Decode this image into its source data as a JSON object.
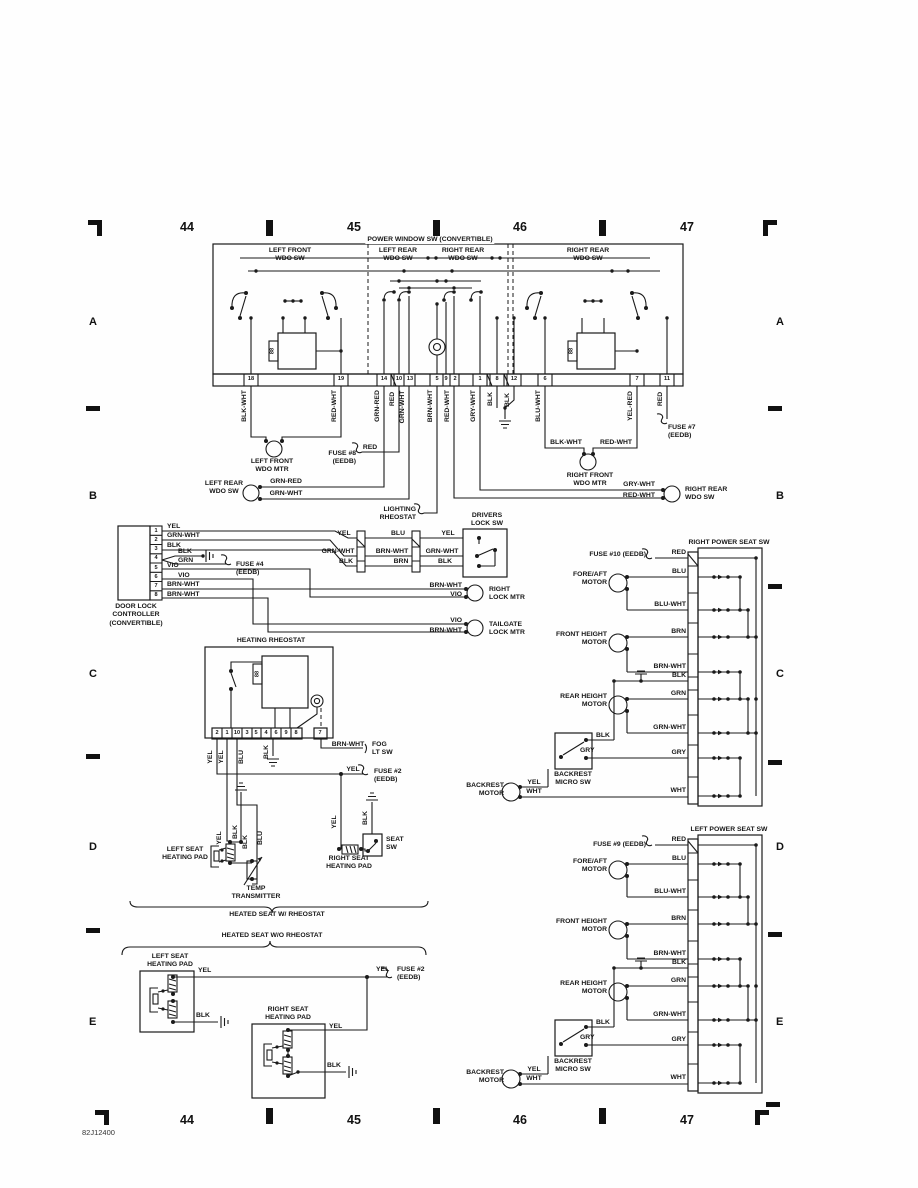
{
  "colors": {
    "ink": "#1a1a1a",
    "paper": "#fefefe"
  },
  "ruler": {
    "top_numbers": [
      "44",
      "45",
      "46",
      "47"
    ],
    "bottom_numbers": [
      "44",
      "45",
      "46",
      "47"
    ],
    "row_letters": [
      "A",
      "B",
      "C",
      "D",
      "E"
    ],
    "code": "82J12400"
  },
  "window_sw": {
    "title": "POWER WINDOW SW (CONVERTIBLE)",
    "sec1": "LEFT FRONT\nWDO SW",
    "sec2": "LEFT REAR\nWDO SW",
    "sec3": "RIGHT REAR\nWDO SW",
    "sec4": "RIGHT REAR\nWDO SW",
    "relay": "88",
    "pins": [
      "18",
      "19",
      "14",
      "10",
      "13",
      "5",
      "9",
      "2",
      "1",
      "8",
      "12",
      "6",
      "7",
      "11"
    ],
    "wire_labels": [
      "BLK-WHT",
      "RED-WHT",
      "GRN-RED",
      "RED",
      "GRN-WHT",
      "BRN-WHT",
      "RED-WHT",
      "GRY-WHT",
      "BLK",
      "BLK",
      "BLU-WHT",
      "YEL-RED",
      "RED"
    ],
    "left_front_mtr": "LEFT FRONT\nWDO MTR",
    "fuse8": "FUSE #8\n(EEDB)",
    "fuse8_wire": "RED",
    "left_rear_sw": "LEFT REAR\nWDO SW",
    "left_rear_wires": [
      "GRN-RED",
      "GRN-WHT"
    ],
    "lighting_rheostat": "LIGHTING\nRHEOSTAT",
    "right_front_mtr": "RIGHT FRONT\nWDO MTR",
    "right_front_wires": [
      "BLK-WHT",
      "RED-WHT"
    ],
    "fuse7": "FUSE #7\n(EEDB)",
    "right_rear_sw": "RIGHT REAR\nWDO SW",
    "right_rear_wires": [
      "GRY-WHT",
      "RED-WHT"
    ]
  },
  "door_lock": {
    "controller": "DOOR LOCK\nCONTROLLER\n(CONVERTIBLE)",
    "pins": [
      "1",
      "2",
      "3",
      "4",
      "5",
      "6",
      "7",
      "8"
    ],
    "pin_wires": [
      "YEL",
      "GRN-WHT",
      "BLK",
      "BLK",
      "GRN",
      "VIO",
      "VIO",
      "BRN-WHT",
      "BRN-WHT"
    ],
    "fuse4": "FUSE #4\n(EEDB)",
    "mid_top": [
      "YEL",
      "BLU",
      "YEL"
    ],
    "mid_mid": [
      "GRN-WHT",
      "BRN-WHT",
      "GRN-WHT"
    ],
    "mid_bot": [
      "BLK",
      "BRN",
      "BLK"
    ],
    "drivers_lock_sw": "DRIVERS\nLOCK SW",
    "right_lock_wires": [
      "BRN-WHT",
      "VIO"
    ],
    "right_lock_mtr": "RIGHT\nLOCK MTR",
    "tailgate_wires": [
      "VIO",
      "BRN-WHT"
    ],
    "tailgate_lock_mtr": "TAILGATE\nLOCK MTR"
  },
  "heating": {
    "title": "HEATING RHEOSTAT",
    "relay": "88",
    "pins": [
      "2",
      "1",
      "10",
      "3",
      "5",
      "4",
      "6",
      "9",
      "8",
      "7"
    ],
    "pin_wires": [
      "YEL",
      "YEL",
      "BLU",
      "BLK"
    ],
    "fog_wire": "BRN-WHT",
    "fog_label": "FOG\nLT SW",
    "fuse2_wire": "YEL",
    "fuse2_label": "FUSE #2\n(EEDB)",
    "left_pad_label": "LEFT SEAT\nHEATING PAD",
    "left_pad_wires": [
      "YEL",
      "BLK",
      "BLK",
      "BLU"
    ],
    "temp_transmitter": "TEMP\nTRANSMITTER",
    "right_pad_label": "RIGHT SEAT\nHEATING PAD",
    "right_pad_wire": "YEL",
    "seat_sw_label": "SEAT\nSW",
    "seat_sw_wire": "BLK",
    "brace1": "HEATED SEAT W/ RHEOSTAT",
    "brace2": "HEATED SEAT W/O RHEOSTAT"
  },
  "no_rheostat": {
    "left_pad": "LEFT SEAT\nHEATING PAD",
    "left_wires": [
      "YEL",
      "BLK"
    ],
    "fuse2_wire": "YEL",
    "fuse2_label": "FUSE #2\n(EEDB)",
    "right_pad": "RIGHT SEAT\nHEATING PAD",
    "right_wires": [
      "YEL",
      "BLK"
    ]
  },
  "seat_right": {
    "title": "RIGHT POWER SEAT SW",
    "fuse": "FUSE #10 (EEDB)",
    "rows": [
      "RED",
      "BLU",
      "BLU-WHT",
      "BRN",
      "BRN-WHT",
      "BLK",
      "GRN",
      "GRN-WHT",
      "GRY",
      "WHT"
    ],
    "fore_aft": "FORE/AFT\nMOTOR",
    "front_height": "FRONT HEIGHT\nMOTOR",
    "rear_height": "REAR HEIGHT\nMOTOR",
    "micro_sw": "BACKREST\nMICRO SW",
    "micro_wires": [
      "BLK",
      "GRY"
    ],
    "backrest": "BACKREST\nMOTOR",
    "backrest_wires": [
      "YEL",
      "WHT"
    ]
  },
  "seat_left": {
    "title": "LEFT POWER SEAT SW",
    "fuse": "FUSE #9 (EEDB)",
    "rows": [
      "RED",
      "BLU",
      "BLU-WHT",
      "BRN",
      "BRN-WHT",
      "BLK",
      "GRN",
      "GRN-WHT",
      "GRY",
      "WHT"
    ],
    "fore_aft": "FORE/AFT\nMOTOR",
    "front_height": "FRONT HEIGHT\nMOTOR",
    "rear_height": "REAR HEIGHT\nMOTOR",
    "micro_sw": "BACKREST\nMICRO SW",
    "micro_wires": [
      "BLK",
      "GRY"
    ],
    "backrest": "BACKREST\nMOTOR",
    "backrest_wires": [
      "YEL",
      "WHT"
    ]
  }
}
